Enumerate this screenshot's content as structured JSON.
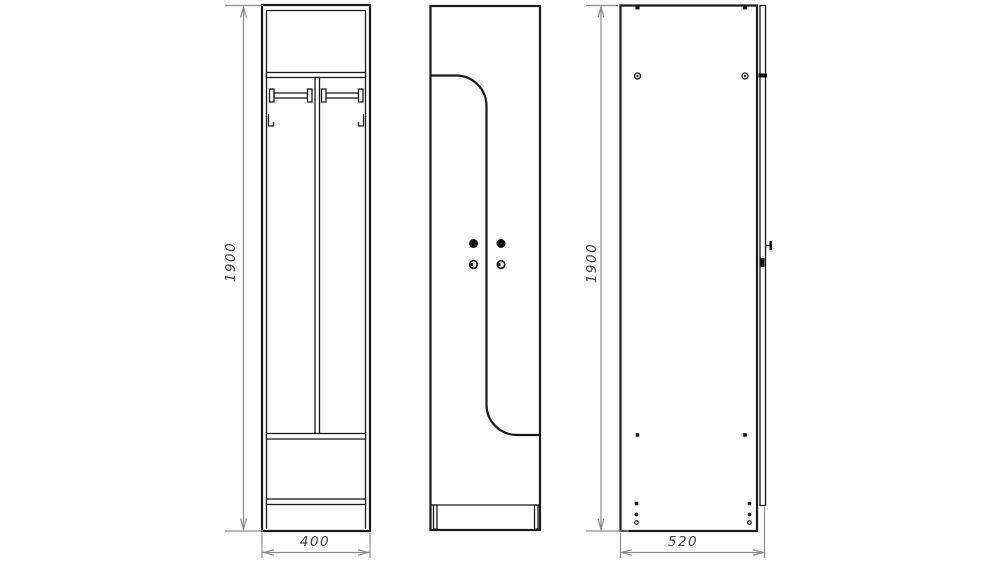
{
  "drawing": {
    "type": "furniture-technical-drawing",
    "subject": "single-section locker wardrobe shown in three orthographic views",
    "colors": {
      "outline": "#1a1a1a",
      "dimension_lines": "#8c8c8c",
      "dimension_text": "#3f3f3f",
      "background": "#ffffff"
    },
    "views": [
      {
        "id": "front-open",
        "description": "front view without doors",
        "features": [
          "top-shelf",
          "center-divider",
          "hanger-rail-left",
          "hanger-rail-right",
          "coat-hook-left",
          "coat-hook-right",
          "mid-shelf",
          "bottom-shelf",
          "plinth"
        ]
      },
      {
        "id": "front-closed",
        "description": "front view with two interlocking L-shaped doors",
        "features": [
          "door-parting-line",
          "door-knob-left",
          "door-knob-right",
          "door-lock-left",
          "door-lock-right",
          "plinth-legs"
        ]
      },
      {
        "id": "side",
        "description": "side view with door edge",
        "features": [
          "side-panel",
          "door-edge-strip",
          "shelf-joint-mark",
          "knob-side",
          "lock-side",
          "assembly-screws"
        ]
      }
    ],
    "dimensions": {
      "front_height": "1900",
      "front_width": "400",
      "side_height": "1900",
      "side_depth": "520"
    }
  }
}
